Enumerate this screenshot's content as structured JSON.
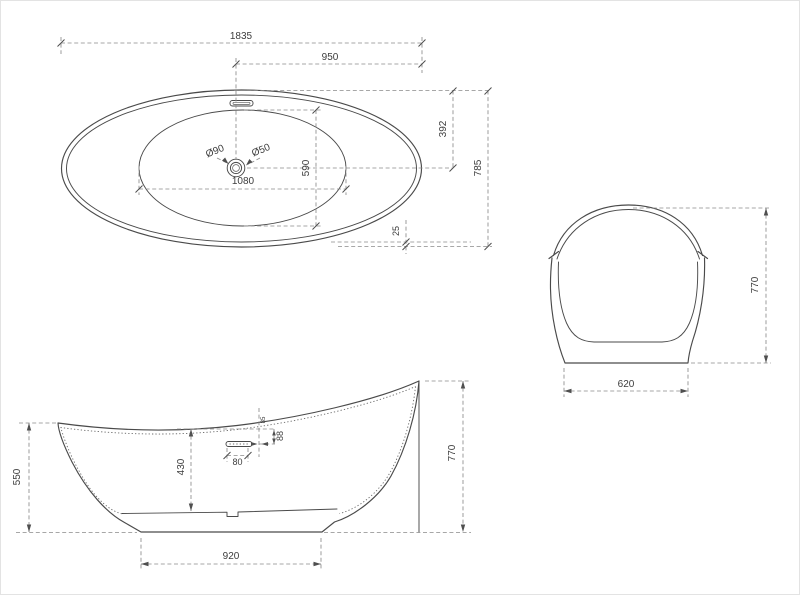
{
  "title": "Bathtub dimensional drawing (three views)",
  "colors": {
    "background": "#ffffff",
    "object_line": "#4a4a4a",
    "dimension_line": "#8b8b8b",
    "text": "#3c3c3c"
  },
  "views": {
    "top": {
      "label": "top view",
      "dims": {
        "overall_length": "1835",
        "drain_to_end": "950",
        "rim_to_centerline": "392",
        "overall_width": "785",
        "basin_width": "590",
        "basin_length": "1080",
        "drain_outer_dia": "Ø90",
        "drain_inner_dia": "Ø50",
        "rim_overhang": "25"
      }
    },
    "end": {
      "label": "end view",
      "dims": {
        "overall_height": "770",
        "base_width": "620"
      }
    },
    "side": {
      "label": "side view",
      "dims": {
        "front_rim_height": "550",
        "inner_depth": "430",
        "overflow_length": "80",
        "overflow_below_rim": "88",
        "overflow_offset": "85",
        "back_height": "770",
        "base_length": "920"
      }
    }
  }
}
